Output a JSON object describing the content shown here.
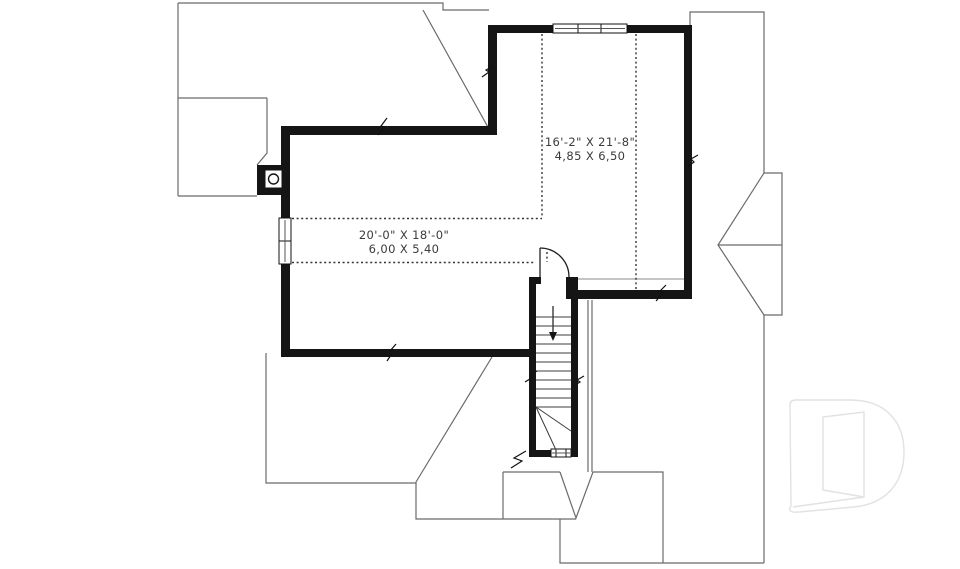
{
  "plan": {
    "type": "architectural-floor-plan-second-floor",
    "rooms": [
      {
        "id": "upper-right-room",
        "imperial": "16'-2\" X 21'-8\"",
        "metric": "4,85 X 6,50"
      },
      {
        "id": "left-room",
        "imperial": "20'-0\" X 18'-0\"",
        "metric": "6,00 X 5,40"
      }
    ],
    "features": {
      "stairs": "straight-run-with-winders-down-arrow",
      "door": "quarter-arc-swing-top-of-stairs",
      "chimney": "square-flue-with-round-pipe",
      "windows": [
        "triple-window-top-wall",
        "double-window-left-wall",
        "small-window-stair-wall"
      ],
      "dotted_lines": "low-ceiling-limit-lines"
    },
    "colors": {
      "background": "#ffffff",
      "wall": "#151515",
      "roof_line": "#6a6a6a",
      "stair_line": "#3c3c3c",
      "dotted_line": "#333333",
      "text": "#3b3b3b",
      "logo_outline": "#e2e2e2"
    }
  },
  "logo": {
    "icon": "stylized-d-outline-watermark"
  }
}
